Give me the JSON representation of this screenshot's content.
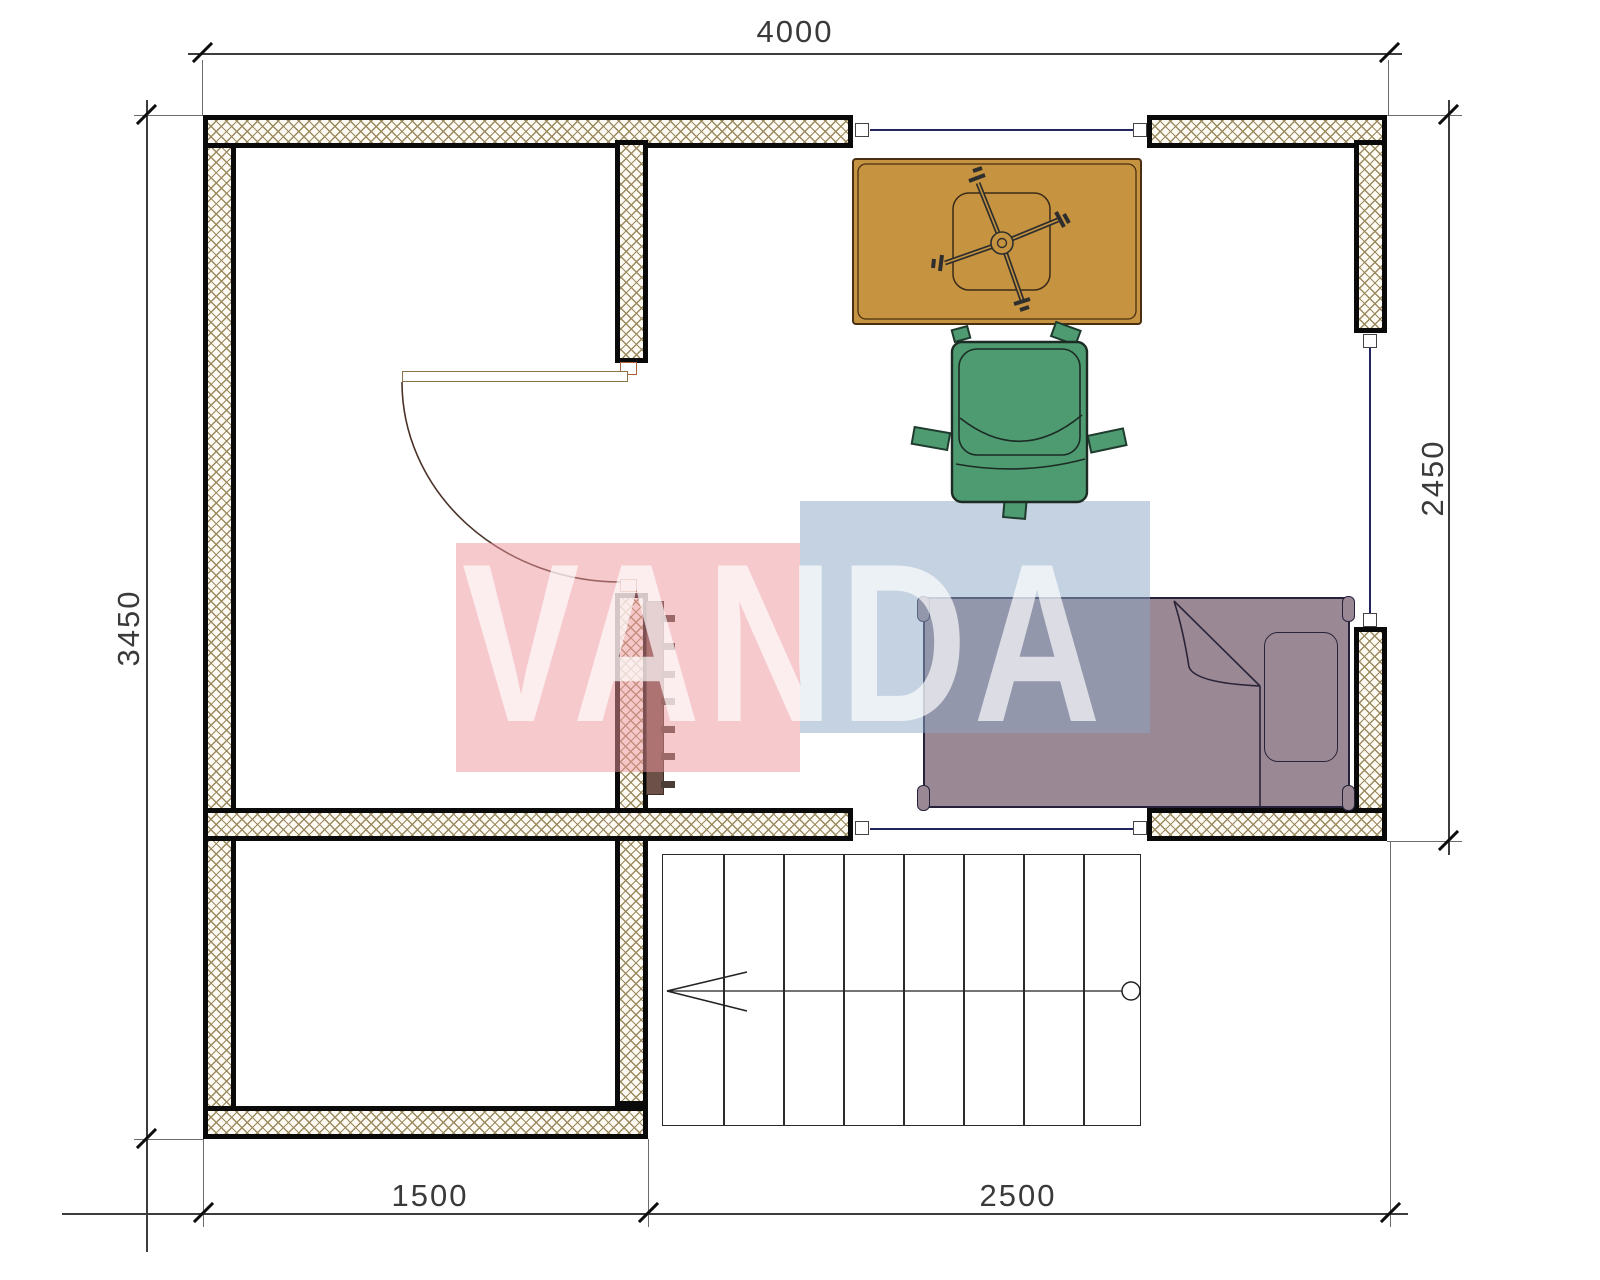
{
  "drawing": {
    "type": "apartment-floor-plan",
    "scale_mm_per_px": 3.37,
    "rooms": [
      "upper-left-room",
      "bedroom-right",
      "lower-left-room",
      "stairwell"
    ]
  },
  "dimensions": {
    "top": "4000",
    "left": "3450",
    "right": "2450",
    "bottom_left": "1500",
    "bottom_right": "2500",
    "units": "mm"
  },
  "watermark": {
    "text": "VANDA",
    "pink_block_color": "#ed949c",
    "blue_block_color": "#8ba5c3",
    "letter_color": "rgba(255,255,255,0.68)"
  },
  "furniture": {
    "desk": {
      "color": "#c69440",
      "name": "desk with office-chair base"
    },
    "chair": {
      "color": "#4e9b72",
      "name": "office chair top view"
    },
    "bed": {
      "color": "#9a8894",
      "name": "single bed with pillow and folded blanket"
    },
    "radiator": {
      "color": "#6d5148",
      "fins": 7
    },
    "stairs": {
      "treads": 8,
      "walk_line": "arrow-left-with-circle"
    }
  },
  "windows": {
    "count": 3,
    "line_color": "#23265e"
  },
  "door": {
    "type": "swing-door",
    "arc_color": "#4a3228"
  }
}
